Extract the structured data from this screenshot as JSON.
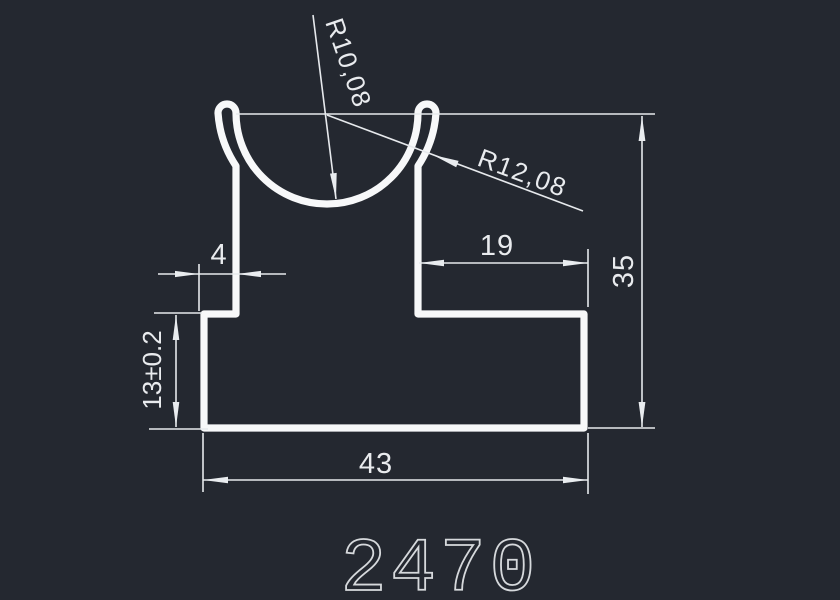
{
  "drawing": {
    "part_number": "2470",
    "dimensions": {
      "bowl_inner_radius": "R10,08",
      "bowl_outer_radius": "R12,08",
      "left_step_width": "4",
      "right_shoulder_width": "19",
      "total_height": "35",
      "base_height": "13±0.2",
      "base_width": "43"
    },
    "colors": {
      "background": "#242830",
      "profile_stroke": "#f7f8f9",
      "dimension_stroke": "#e6e9ec",
      "part_number_stroke": "#d6d9dc"
    }
  }
}
